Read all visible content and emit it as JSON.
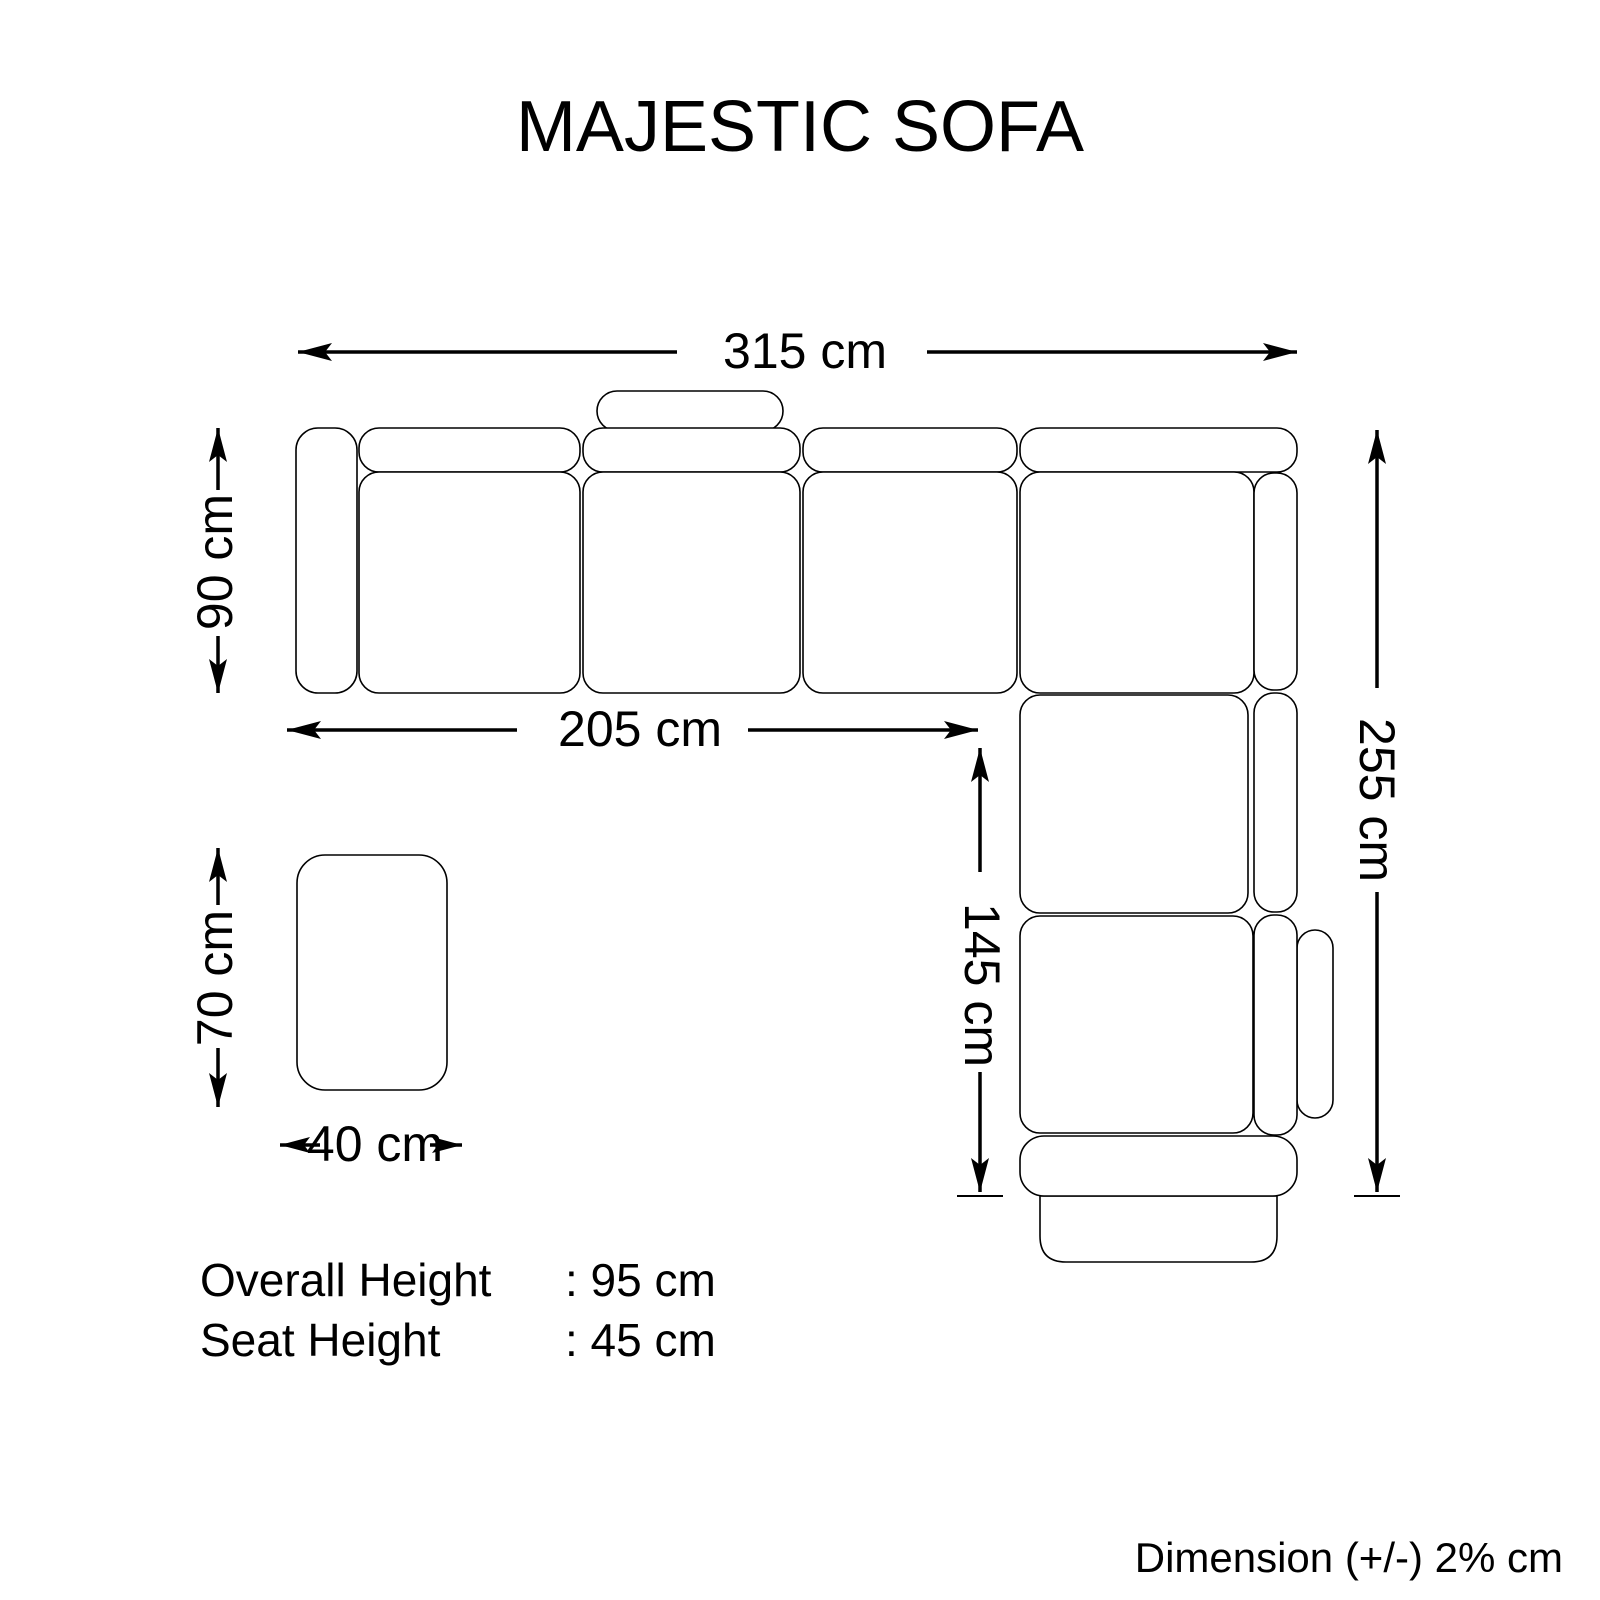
{
  "title": "MAJESTIC SOFA",
  "dimensions": {
    "overall_width": "315 cm",
    "seat_depth": "90 cm",
    "left_wing_width": "205 cm",
    "chaise_extension": "145 cm",
    "overall_depth": "255 cm",
    "ottoman_length": "70 cm",
    "ottoman_width": "40 cm"
  },
  "specs": {
    "rows": [
      {
        "label": "Overall Height",
        "value": ": 95 cm"
      },
      {
        "label": "Seat Height",
        "value": ": 45 cm"
      }
    ]
  },
  "footer": {
    "note": "Dimension (+/-) 2% cm"
  },
  "colors": {
    "line": "#000000",
    "background": "#ffffff"
  }
}
